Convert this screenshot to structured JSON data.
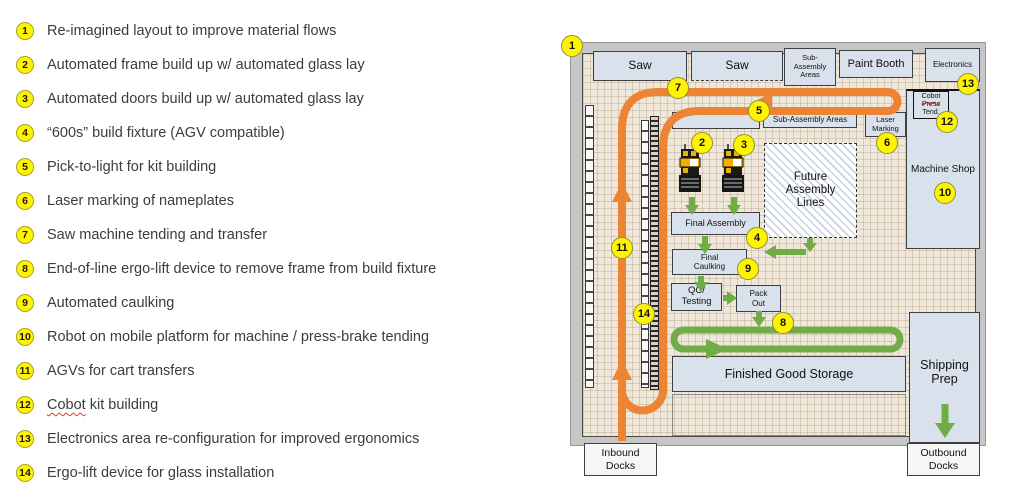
{
  "colors": {
    "accent_orange": "#ED8433",
    "flow_green": "#70AD47",
    "badge_yellow": "#FFF400",
    "room_fill": "#D9E1EC",
    "floor": "#EFE7D9",
    "wall_gray": "#C6C6C6"
  },
  "legend": {
    "items": [
      {
        "n": "1",
        "text": "Re-imagined layout to improve material flows"
      },
      {
        "n": "2",
        "text": "Automated frame build up w/ automated glass lay"
      },
      {
        "n": "3",
        "text": "Automated doors build up w/ automated glass lay"
      },
      {
        "n": "4",
        "text": "“600s” build fixture (AGV compatible)"
      },
      {
        "n": "5",
        "text": "Pick-to-light for kit building"
      },
      {
        "n": "6",
        "text": "Laser marking of nameplates"
      },
      {
        "n": "7",
        "text": "Saw machine tending and transfer"
      },
      {
        "n": "8",
        "text": "End-of-line ergo-lift device to remove frame from build fixture"
      },
      {
        "n": "9",
        "text": "Automated caulking"
      },
      {
        "n": "10",
        "text": "Robot on mobile platform for machine / press-brake tending"
      },
      {
        "n": "11",
        "text": "AGVs for cart transfers"
      },
      {
        "n": "12",
        "text": "Cobot kit building",
        "squiggle_word": "Cobot"
      },
      {
        "n": "13",
        "text": "Electronics area re-configuration for improved ergonomics"
      },
      {
        "n": "14",
        "text": "Ergo-lift device for glass installation"
      }
    ]
  },
  "diagram": {
    "rooms": {
      "saw1": "Saw",
      "saw2": "Saw",
      "sub_assembly_top": "Sub-Assembly Areas",
      "paint_booth": "Paint Booth",
      "electronics": "Electronics",
      "sub_assembly_2": "Sub-Assembly Areas",
      "laser_marking": "Laser Marking",
      "cobot_press_tend": {
        "line1": "Cobot",
        "line2": "Press",
        "line3": "Tend."
      },
      "machine_shop": "Machine Shop",
      "future_assembly": "Future Assembly Lines",
      "final_assembly": "Final Assembly",
      "final_caulking": "Final Caulking",
      "qc_testing": "QC/ Testing",
      "pack_out": "Pack Out",
      "finished_goods": "Finished Good Storage",
      "shipping_prep": "Shipping Prep",
      "inbound_docks": "Inbound Docks",
      "outbound_docks": "Outbound Docks"
    },
    "badges": [
      "1",
      "7",
      "5",
      "2",
      "3",
      "6",
      "13",
      "12",
      "10",
      "4",
      "9",
      "8",
      "11",
      "14"
    ]
  }
}
